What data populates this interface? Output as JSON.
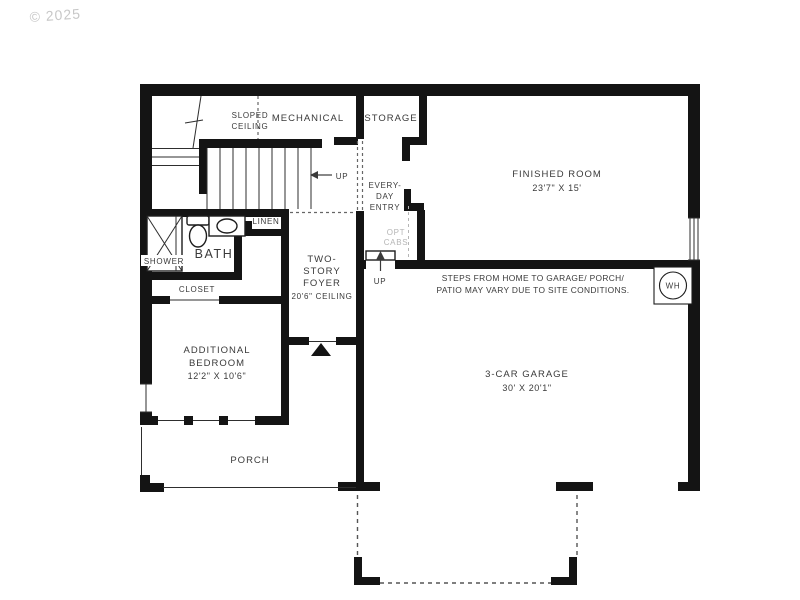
{
  "watermark": "© 2025",
  "plan": {
    "sloped_ceiling": [
      "SLOPED",
      "CEILING"
    ],
    "mechanical": "MECHANICAL",
    "storage": "STORAGE",
    "finished_room": [
      "FINISHED ROOM",
      "23'7\" X 15'"
    ],
    "everyday_entry": [
      "EVERY-",
      "DAY",
      "ENTRY"
    ],
    "opt_cabs": [
      "OPT",
      "CABS"
    ],
    "stairs_up": "UP",
    "linen": "LINEN",
    "bath": "BATH",
    "shower": "SHOWER",
    "closet": "CLOSET",
    "foyer": [
      "TWO-",
      "STORY",
      "FOYER",
      "20'6\" CEILING"
    ],
    "bedroom": [
      "ADDITIONAL",
      "BEDROOM",
      "12'2\" X 10'6\""
    ],
    "entry_steps_up": "UP",
    "note": [
      "STEPS FROM HOME TO GARAGE/ PORCH/",
      "PATIO MAY VARY DUE TO SITE CONDITIONS."
    ],
    "garage": [
      "3-CAR GARAGE",
      "30' X 20'1\""
    ],
    "water_heater": "WH",
    "porch": "PORCH"
  },
  "colors": {
    "wall": "#141414",
    "text": "#3a3a3a",
    "muted_text": "#b5b5b5",
    "watermark": "#c7c7c7",
    "background": "#ffffff"
  }
}
